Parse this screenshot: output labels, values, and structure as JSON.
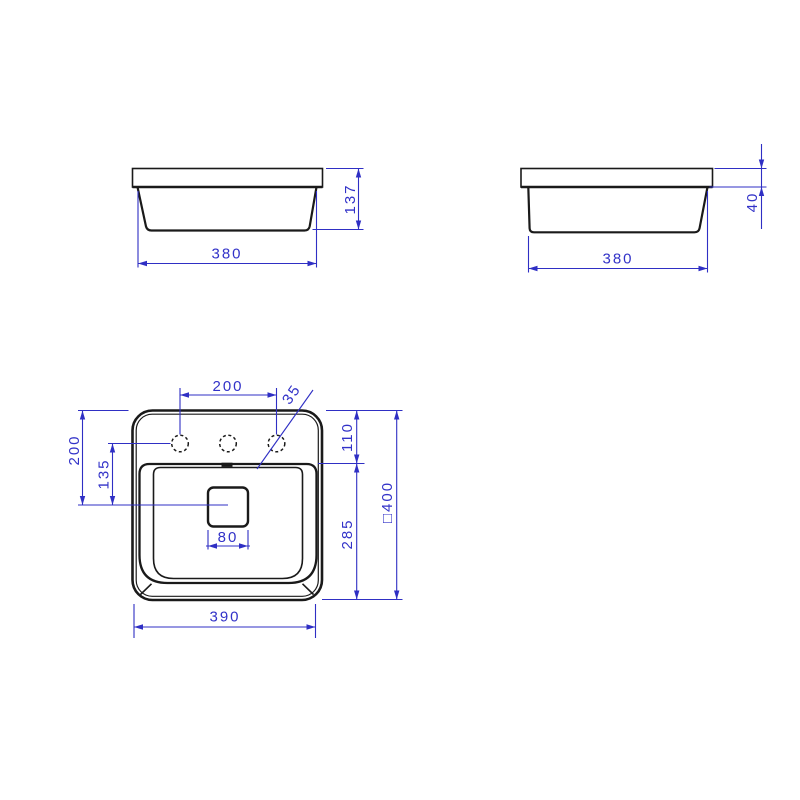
{
  "drawing": {
    "type": "technical dimension drawing",
    "subject": "square semi-recessed washbasin, three orthographic views",
    "colors": {
      "outline": "#1a1a1a",
      "dimension": "#2f2fc4",
      "background": "#ffffff"
    },
    "side_view_a": {
      "width": "380",
      "height": "137"
    },
    "side_view_b": {
      "width": "380",
      "rim_height": "40"
    },
    "plan_view": {
      "hole_spacing": "200",
      "hole_diameter": "35",
      "edge_to_basin": "110",
      "edge_to_drain": "200",
      "holes_to_drain": "135",
      "drain_size": "80",
      "basin_depth": "285",
      "overall_square": "□400",
      "bottom_width": "390"
    }
  }
}
